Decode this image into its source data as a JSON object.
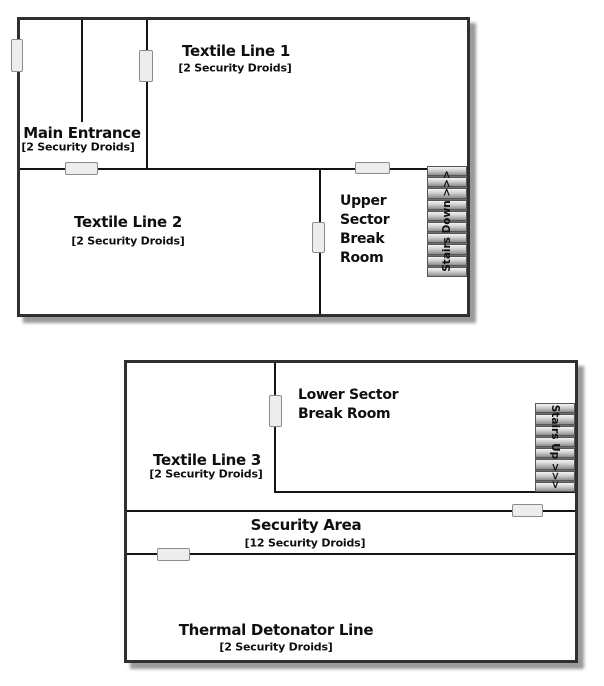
{
  "figure": {
    "type": "floorplan",
    "levels": 2
  },
  "colors": {
    "background": "#ffffff",
    "wall_outer": "#2f2f2f",
    "wall_inner": "#141414",
    "door_fill": "#ededed",
    "door_border": "#8c8c8c",
    "stair_light": "#f4f4f4",
    "stair_dark": "#8d8d8d",
    "shadow": "#9a9a9a",
    "text": "#0f0f0f"
  },
  "upper_floor": {
    "rooms": {
      "textile_line_1": {
        "title": "Textile Line 1",
        "subtitle": "[2 Security Droids]"
      },
      "main_entrance": {
        "title": "Main Entrance",
        "subtitle": "[2 Security Droids]"
      },
      "textile_line_2": {
        "title": "Textile Line 2",
        "subtitle": "[2 Security Droids]"
      },
      "upper_break_room": {
        "title": "Upper\nSector\nBreak\nRoom"
      }
    },
    "stairs": {
      "label": "Stairs Down >>>",
      "direction": "down",
      "treads": 10
    },
    "door_count": 5
  },
  "lower_floor": {
    "rooms": {
      "lower_break_room": {
        "title": "Lower Sector\nBreak Room"
      },
      "textile_line_3": {
        "title": "Textile Line 3",
        "subtitle": "[2 Security Droids]"
      },
      "security_area": {
        "title": "Security Area",
        "subtitle": "[12 Security Droids]"
      },
      "thermal_detonator_line": {
        "title": "Thermal Detonator Line",
        "subtitle": "[2 Security Droids]"
      }
    },
    "stairs": {
      "label": "Stairs Up >>>",
      "direction": "up",
      "treads": 8
    },
    "door_count": 3
  }
}
